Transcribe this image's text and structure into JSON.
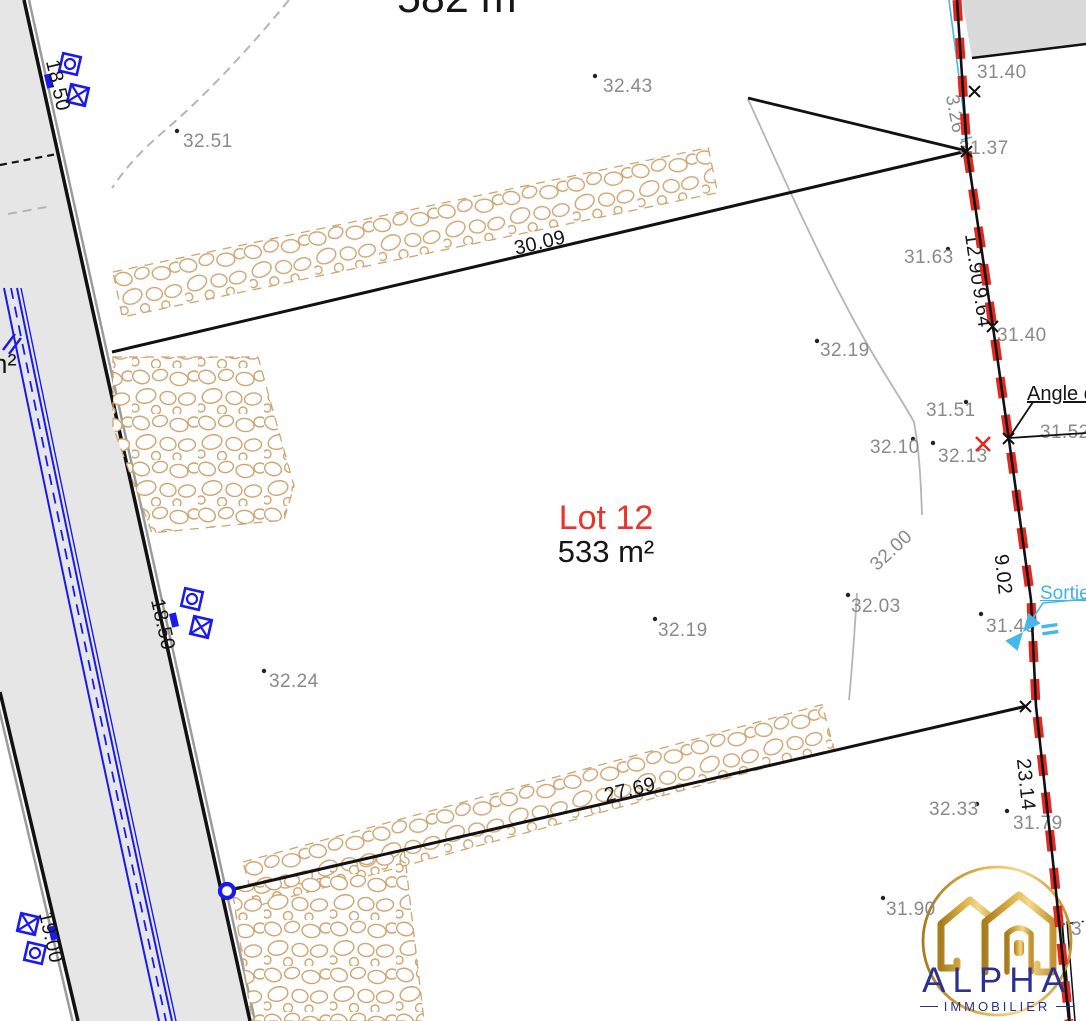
{
  "plan": {
    "lot12_title": "Lot 12",
    "lot12_area": "533 m²",
    "lot11_area": "582 m²",
    "left_area_fragment": "m²",
    "right_edge_fragment": "3",
    "angle_label": "Angle de",
    "sortie_label": "Sortie"
  },
  "dims": {
    "top": "30.09",
    "bottom": "27.69",
    "right_1": "12.90",
    "right_2": "9.64",
    "right_3": "9.02",
    "right_4": "23.14",
    "cyan": "3.26",
    "road_top": "18.50",
    "road_mid": "18.50",
    "road_bottom": "19.00"
  },
  "elev": {
    "e1": "32.43",
    "e2": "32.51",
    "e3": "31.40",
    "e4": "31.37",
    "e5": "31.63",
    "e6": "31.40",
    "e7": "32.19",
    "e8": "31.51",
    "e9": "32.10",
    "e10": "32.13",
    "e11": "31.52",
    "e12": "32.00",
    "e13": "32.03",
    "e14": "31.46",
    "e15": "32.19",
    "e16": "32.24",
    "e17": "32.33",
    "e18": "31.79",
    "e19": "31.90"
  },
  "logo": {
    "brand": "ALPHA",
    "tagline": "IMMOBILIER"
  },
  "colors": {
    "boundary_red": "#e5261f",
    "lot_red": "#e8352b",
    "survey_blue": "#1a1aee",
    "cyan": "#45b8e8",
    "stone": "#cfa470",
    "road_gray": "#e6e6e6",
    "text_gray": "#8a8a8a",
    "logo_navy": "#2c3190",
    "logo_gold": "#d9ad42"
  }
}
